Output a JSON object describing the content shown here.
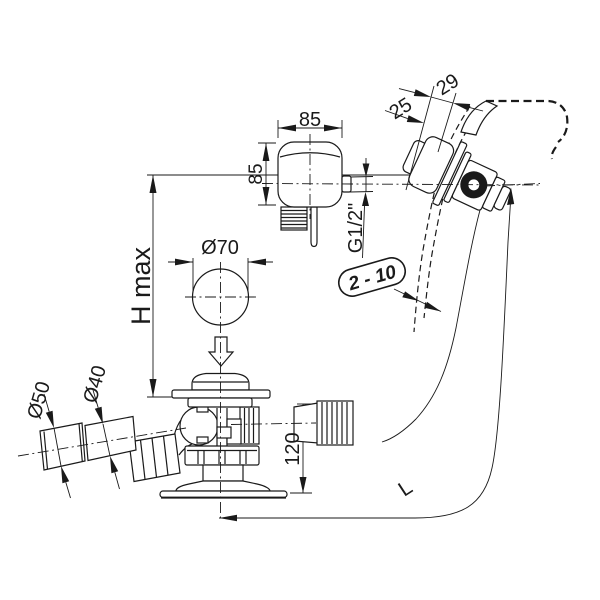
{
  "labels": {
    "dim_top_width": "85",
    "dim_side_height": "85",
    "dim_29": "29",
    "dim_25": "25",
    "thread_size": "G1/2\"",
    "plug_diameter": "Ø70",
    "height_max": "H max",
    "wall_thickness_range": "2 - 10",
    "socket_diameter": "Ø50",
    "pipe_diameter": "Ø40",
    "dim_outlet_height": "120",
    "hose_length": "L"
  },
  "colors": {
    "line": "#1a1a1a",
    "background": "#ffffff"
  }
}
